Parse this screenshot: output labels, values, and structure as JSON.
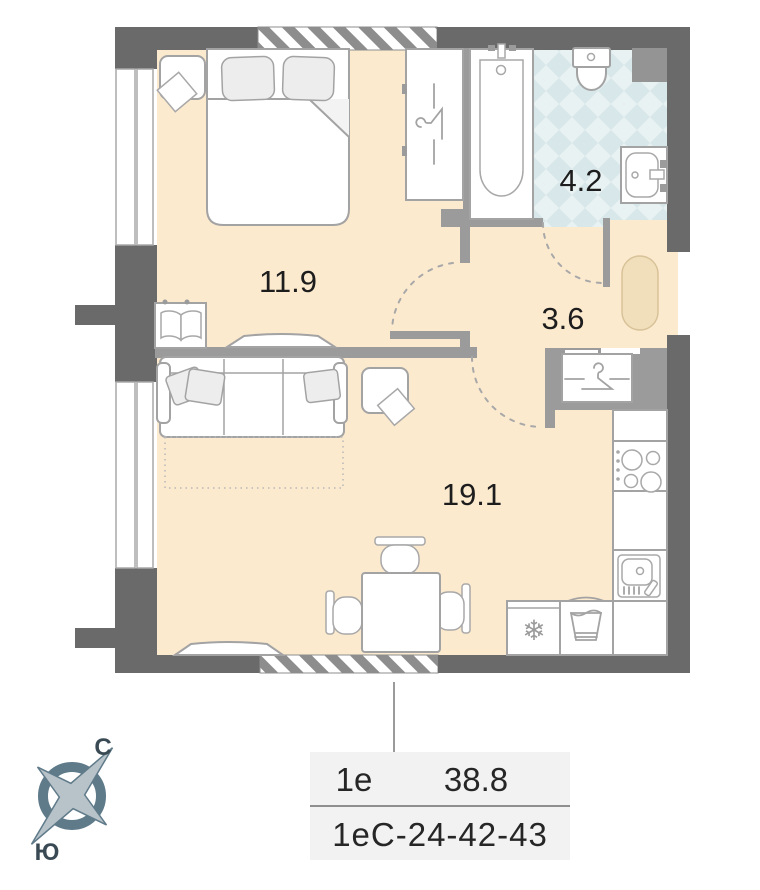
{
  "floor_plan": {
    "type": "apartment-floor-plan",
    "rooms": {
      "bedroom": {
        "name": "bedroom",
        "area": "11.9"
      },
      "bathroom": {
        "name": "bathroom",
        "area": "4.2"
      },
      "hallway": {
        "name": "hallway",
        "area": "3.6"
      },
      "living_kitchen": {
        "name": "living-kitchen",
        "area": "19.1"
      }
    },
    "legend": {
      "layout": "1е",
      "total_area": "38.8",
      "code": "1еС-24-42-43"
    },
    "compass": {
      "north_label": "С",
      "south_label": "Ю"
    },
    "icons": {
      "fridge_snowflake": "❄"
    },
    "colors": {
      "floor": "#fceacf",
      "exterior_wall": "#6a6a6a",
      "partition_wall": "#9b9b9b",
      "tile_base": "#e9f2f3",
      "tile_diamond": "#d8e7e9",
      "oval_rug": "#f1dfbc",
      "legend_bg": "#f2f2f2",
      "compass_slate": "#5f7a89"
    }
  }
}
